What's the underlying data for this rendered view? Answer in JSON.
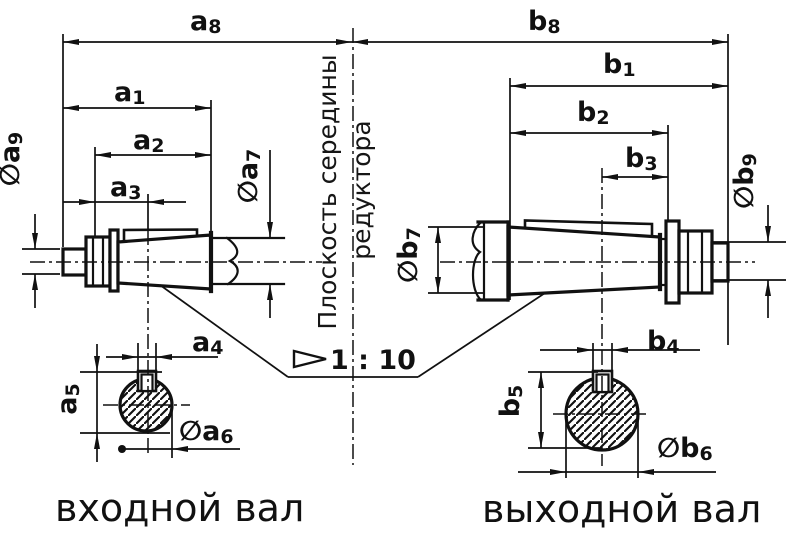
{
  "drawing": {
    "background": "#ffffff",
    "line_color": "#111111",
    "captions": {
      "left_shaft": "входной вал",
      "right_shaft": "выходной вал"
    },
    "center_plane_label": {
      "line1": "Плоскость середины",
      "line2": "редуктора"
    },
    "taper_note": {
      "ratio": "1 : 10"
    },
    "dimensions": {
      "a8": {
        "base": "a",
        "sub": "8"
      },
      "a1": {
        "base": "a",
        "sub": "1"
      },
      "a2": {
        "base": "a",
        "sub": "2"
      },
      "a3": {
        "base": "a",
        "sub": "3"
      },
      "a4": {
        "base": "a",
        "sub": "4"
      },
      "a5": {
        "base": "a",
        "sub": "5"
      },
      "a6": {
        "prefix": "∅",
        "base": "a",
        "sub": "6"
      },
      "a7": {
        "prefix": "∅",
        "base": "a",
        "sub": "7"
      },
      "a9": {
        "prefix": "∅",
        "base": "a",
        "sub": "9"
      },
      "b8": {
        "base": "b",
        "sub": "8"
      },
      "b1": {
        "base": "b",
        "sub": "1"
      },
      "b2": {
        "base": "b",
        "sub": "2"
      },
      "b3": {
        "base": "b",
        "sub": "3"
      },
      "b4": {
        "base": "b",
        "sub": "4"
      },
      "b5": {
        "base": "b",
        "sub": "5"
      },
      "b6": {
        "prefix": "∅",
        "base": "b",
        "sub": "6"
      },
      "b7": {
        "prefix": "∅",
        "base": "b",
        "sub": "7"
      },
      "b9": {
        "prefix": "∅",
        "base": "b",
        "sub": "9"
      }
    }
  }
}
